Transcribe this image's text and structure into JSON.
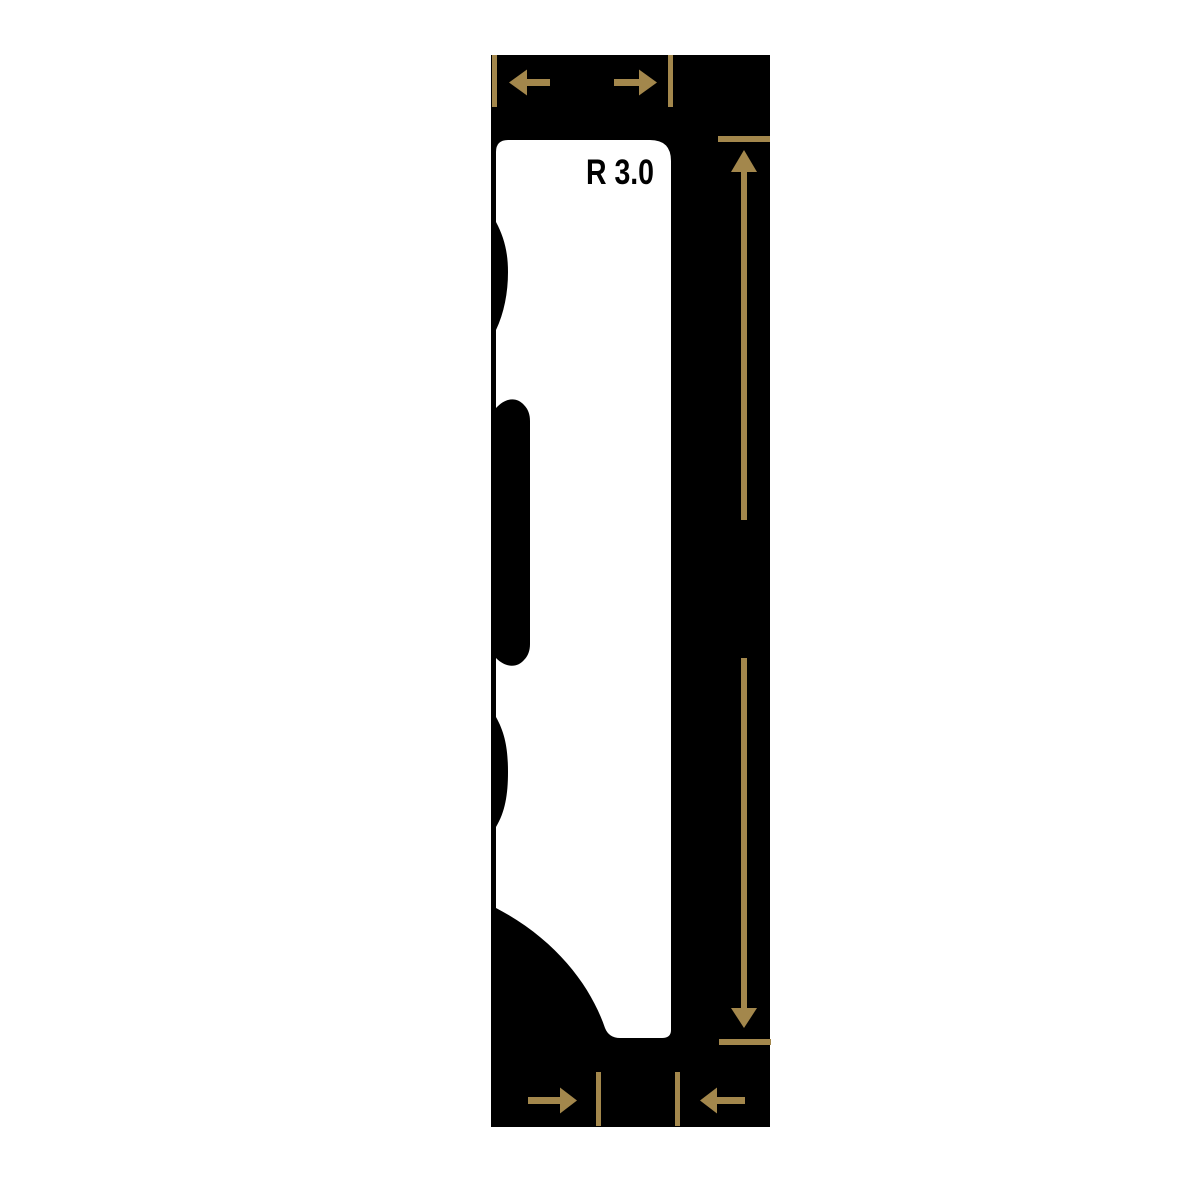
{
  "diagram": {
    "radius_label": "R 3.0",
    "colors": {
      "page_background": "#ffffff",
      "panel": "#000000",
      "profile": "#ffffff",
      "dimension_gold": "#A3874C",
      "label_text": "#000000"
    },
    "dimension_indicators": [
      {
        "id": "width-top",
        "orientation": "horizontal"
      },
      {
        "id": "height-right",
        "orientation": "vertical"
      },
      {
        "id": "thickness-bottom",
        "orientation": "horizontal"
      }
    ]
  }
}
